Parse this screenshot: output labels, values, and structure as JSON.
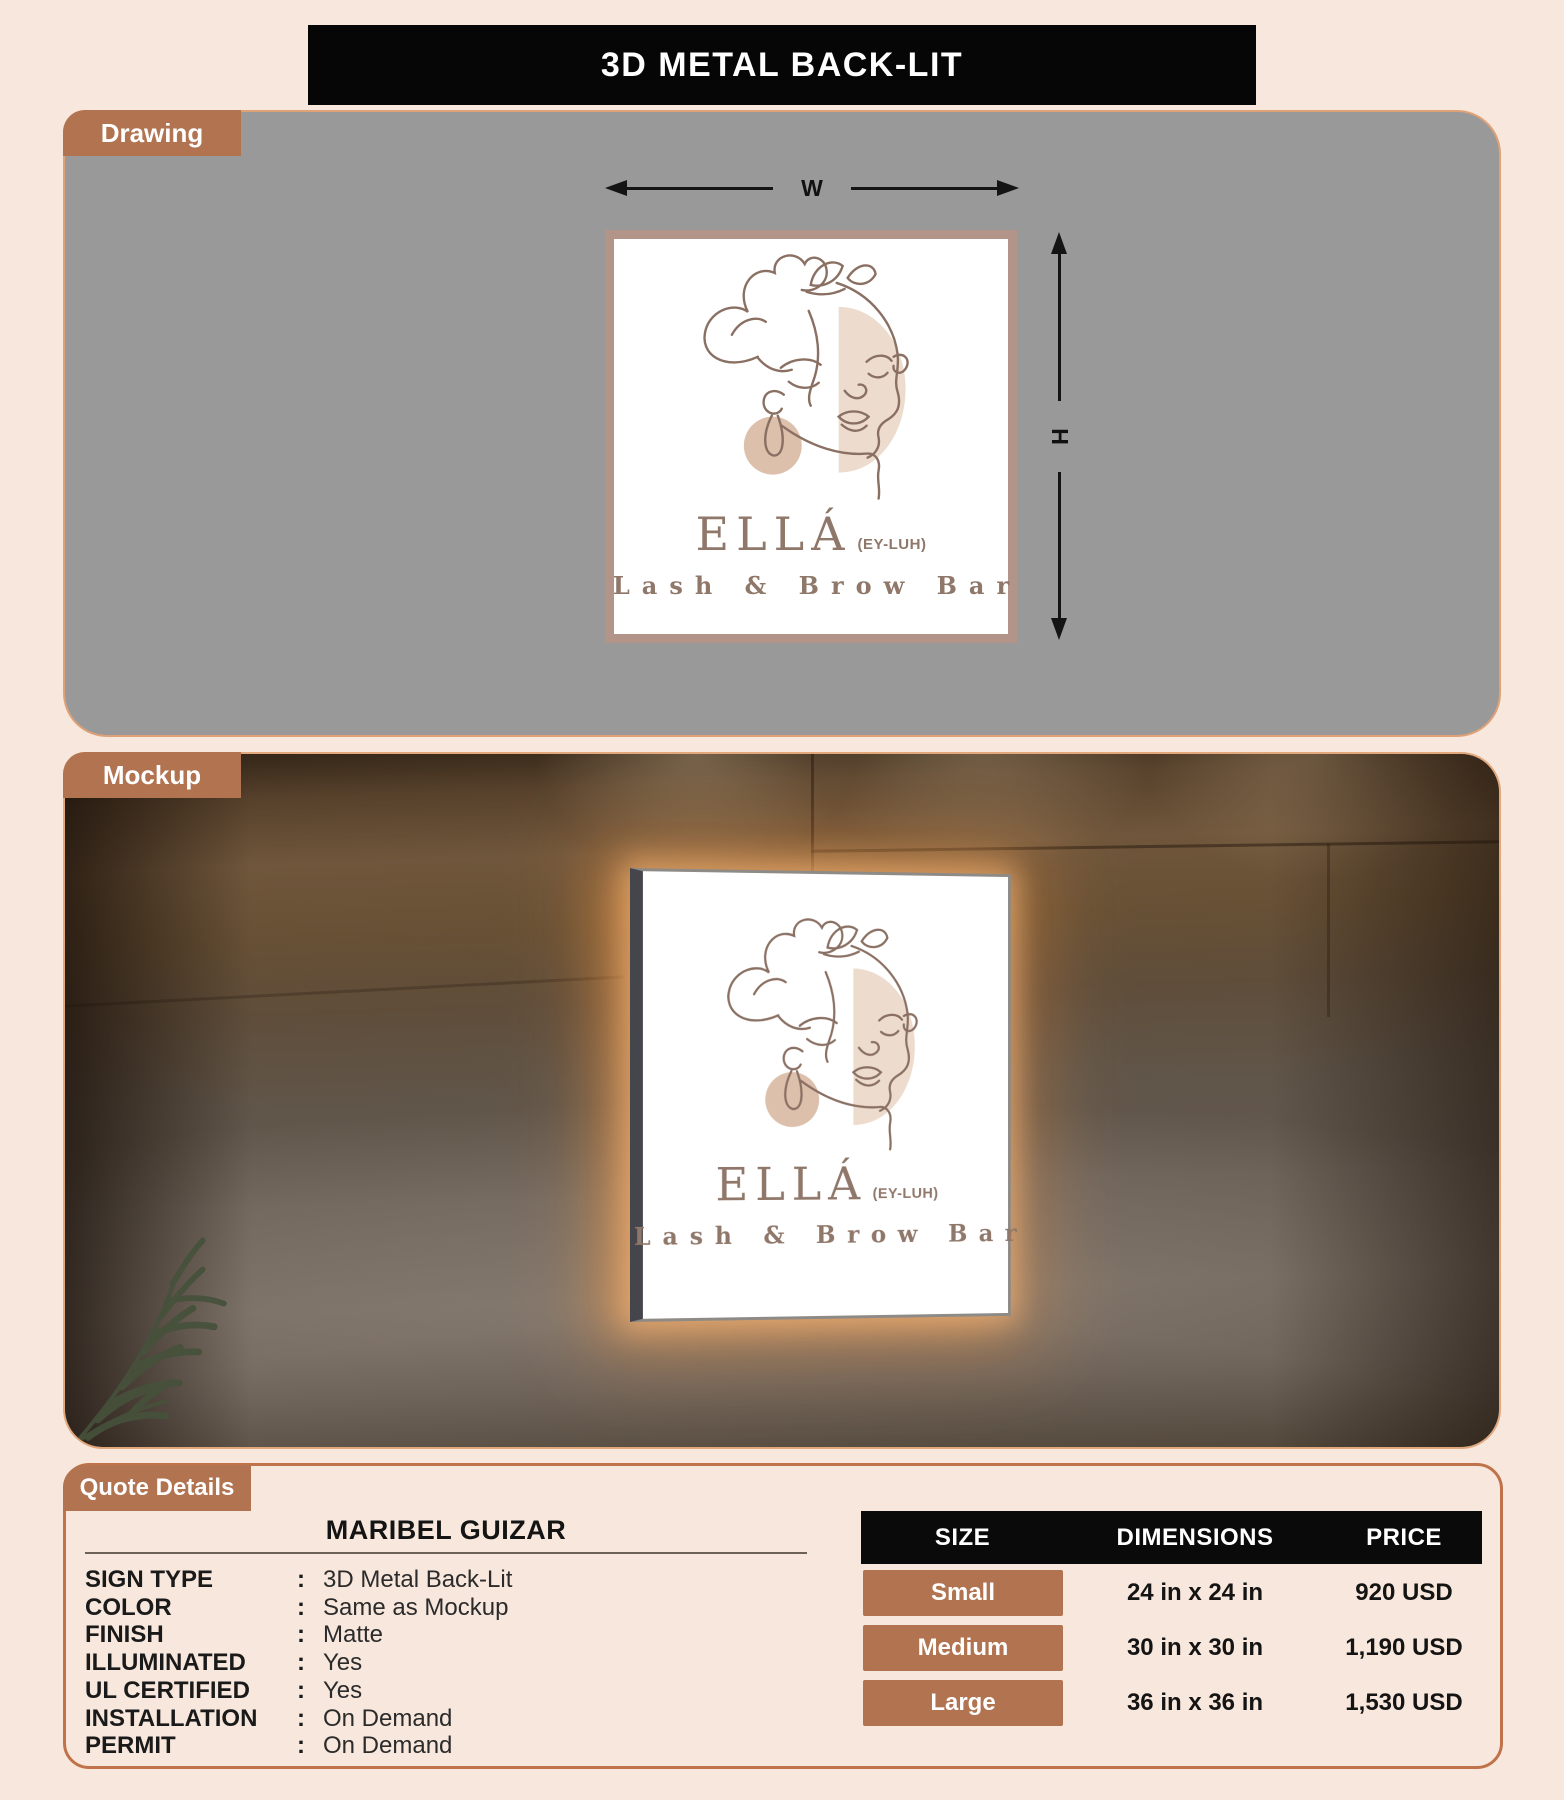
{
  "page": {
    "title": "3D METAL BACK-LIT"
  },
  "colors": {
    "page_bg": "#f8e7dc",
    "accent_copper": "#b17350",
    "panel_border_copper": "#c0734a",
    "drawing_bg": "#9a999a",
    "table_header_bg": "#0a0a0a",
    "sign_border": "#b29488",
    "logo_line": "#8a7063",
    "logo_text": "#8f7769",
    "backlit_glow": "#f0a05f",
    "plant_green": "#46513a"
  },
  "drawing": {
    "tab_label": "Drawing",
    "dim_w": "W",
    "dim_h": "H"
  },
  "mockup": {
    "tab_label": "Mockup"
  },
  "brand": {
    "name": "ELLÁ",
    "pronunciation": "(EY-LUH)",
    "tagline": "Lash & Brow Bar"
  },
  "quote": {
    "tab_label": "Quote Details",
    "customer": "MARIBEL GUIZAR",
    "separator": ":",
    "details": [
      {
        "label": "SIGN TYPE",
        "value": "3D Metal Back-Lit"
      },
      {
        "label": "COLOR",
        "value": "Same as Mockup"
      },
      {
        "label": "FINISH",
        "value": "Matte"
      },
      {
        "label": "ILLUMINATED",
        "value": "Yes"
      },
      {
        "label": "UL CERTIFIED",
        "value": "Yes"
      },
      {
        "label": "INSTALLATION",
        "value": "On Demand"
      },
      {
        "label": "PERMIT",
        "value": "On Demand"
      }
    ]
  },
  "pricing": {
    "headers": [
      "SIZE",
      "DIMENSIONS",
      "PRICE"
    ],
    "rows": [
      {
        "size": "Small",
        "dimensions": "24 in x 24 in",
        "price": "920 USD"
      },
      {
        "size": "Medium",
        "dimensions": "30 in x 30 in",
        "price": "1,190 USD"
      },
      {
        "size": "Large",
        "dimensions": "36 in x 36 in",
        "price": "1,530 USD"
      }
    ]
  }
}
